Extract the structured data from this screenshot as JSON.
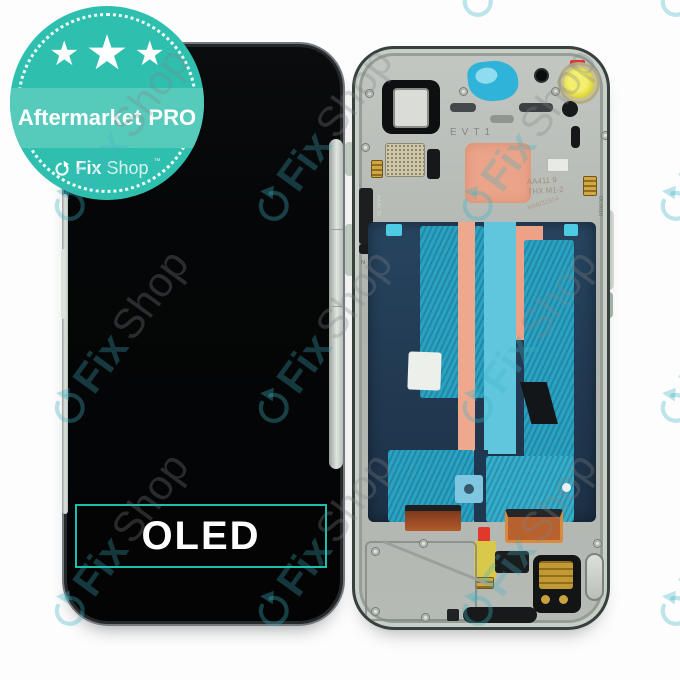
{
  "badge": {
    "star_glyph": "★",
    "title_regular": "Aftermarket",
    "title_bold": "PRO",
    "brand": {
      "fix": "Fix",
      "shop": "Shop",
      "tm": "™"
    },
    "colors": {
      "circle": "#2fbfae",
      "band": "#56cbbb"
    }
  },
  "front_panel": {
    "label": "OLED",
    "accent_color": "#1bbfab"
  },
  "back_panel": {
    "markings": {
      "evt": "EVT1",
      "code_line1": "AA411 9",
      "code_line2": "THX M1-2",
      "date_stamp": "MM031914",
      "side_code": "AA41 39",
      "bottom_code": "N 4139 2119",
      "right_code": "DC0016"
    },
    "colors": {
      "frame_silver": "#b6bab5",
      "battery_navy": "#22405c",
      "graphite_cyan": "#2aa2c2",
      "thermal_salmon": "#eba489",
      "copper": "#b35a2c",
      "coil_yellow": "#e8df4a",
      "marker_red": "#e23427"
    }
  },
  "watermark": {
    "fix": "Fix",
    "shop": "Shop",
    "teal": "#3eb2c3"
  }
}
